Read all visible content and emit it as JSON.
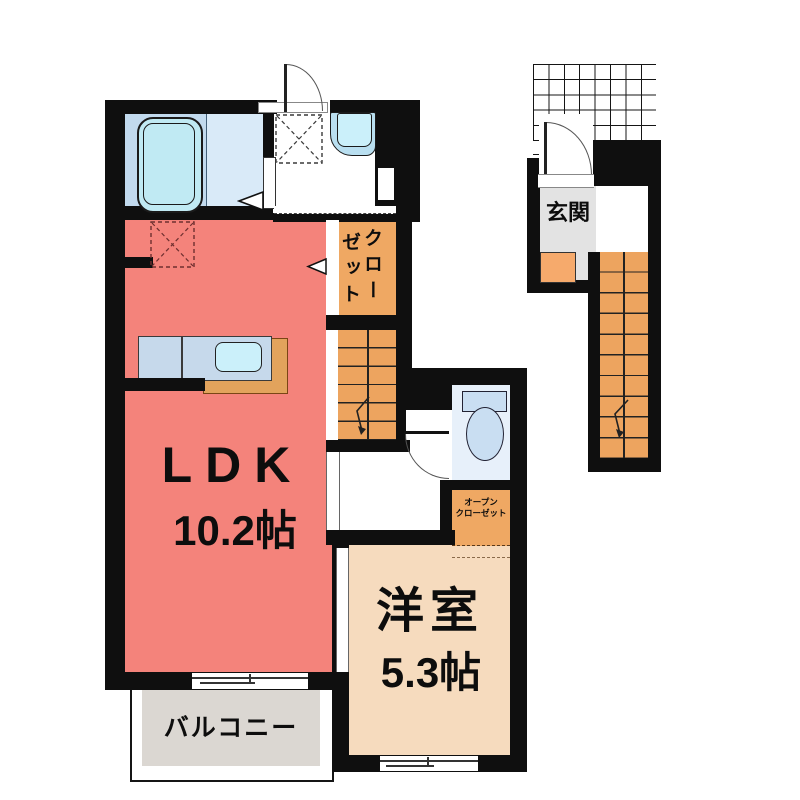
{
  "plan_title": "apartment-floor-plan",
  "rooms": {
    "ldk": {
      "label": "LDK",
      "size": "10.2帖"
    },
    "western_room": {
      "label": "洋室",
      "size": "5.3帖"
    },
    "balcony": {
      "label": "バルコニー"
    },
    "entrance": {
      "label": "玄関"
    },
    "closet": {
      "label": "クローゼット",
      "vertical_col_right": "クロー",
      "vertical_col_left": "ゼット"
    },
    "open_closet": {
      "label": "オープンクローゼット",
      "line1": "オープン",
      "line2": "クローゼット"
    }
  },
  "fixtures": {
    "bathtub": "bathtub",
    "washing_machine_space": "washing-machine-space (dashed box)",
    "bathroom_sink": "bathroom-sink",
    "kitchen_counter": "kitchen-counter-with-sink",
    "refrigerator_space": "refrigerator-space (dashed box)",
    "toilet": "toilet",
    "staircase_lower": "staircase-with-down-arrow",
    "staircase_upper": "staircase-with-down-arrow",
    "entrance_step": "entrance-step",
    "porch_grid": "entry-porch-grid"
  },
  "colors": {
    "wall": "#0F0F0F",
    "ldk_floor": "#F4837B",
    "western_floor": "#F6DBBE",
    "closet_floor": "#EFA863",
    "stairs_floor": "#EDA45F",
    "entrance_step": "#F6AA6C",
    "entrance_floor": "#E3E3E3",
    "balcony_deck": "#DBD7D2",
    "bath_floor": "#C2DAEE",
    "bath_floor_light": "#D9EAF8",
    "fixture_blue": "#C0EAF3",
    "toilet_blue": "#C9DEF2",
    "counter_blue": "#C6D9EB"
  }
}
